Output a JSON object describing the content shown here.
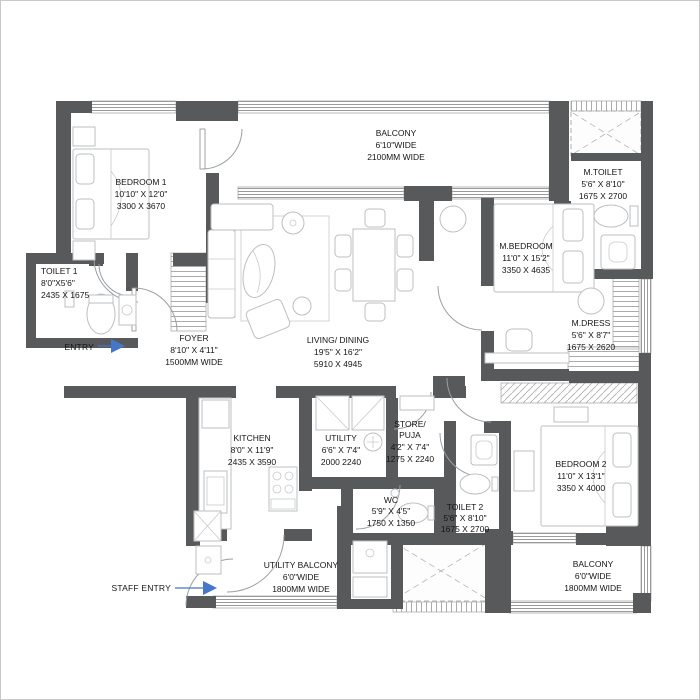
{
  "plan_title": "apartment-floor-plan",
  "rooms": {
    "balcony_top": {
      "name": "BALCONY",
      "size_ft": "6'10\"WIDE",
      "size_mm": "2100MM WIDE"
    },
    "bedroom1": {
      "name": "BEDROOM 1",
      "size_ft": "10'10\" X 12'0\"",
      "size_mm": "3300 X 3670"
    },
    "m_toilet": {
      "name": "M.TOILET",
      "size_ft": "5'6\" X 8'10\"",
      "size_mm": "1675 X 2700"
    },
    "m_bedroom": {
      "name": "M.BEDROOM",
      "size_ft": "11'0\" X 15'2\"",
      "size_mm": "3350 X 4635"
    },
    "m_dress": {
      "name": "M.DRESS",
      "size_ft": "5'6\" X 8'7\"",
      "size_mm": "1675 X 2620"
    },
    "toilet1": {
      "name": "TOILET 1",
      "size_ft": "8'0\"X5'6\"",
      "size_mm": "2435 X 1675"
    },
    "foyer": {
      "name": "FOYER",
      "size_ft": "8'10\" X 4'11\"",
      "size_mm": "1500MM WIDE"
    },
    "living_dining": {
      "name": "LIVING/ DINING",
      "size_ft": "19'5\" X 16'2\"",
      "size_mm": "5910 X 4945"
    },
    "kitchen": {
      "name": "KITCHEN",
      "size_ft": "8'0\" X 11'9\"",
      "size_mm": "2435 X 3590"
    },
    "utility": {
      "name": "UTILITY",
      "size_ft": "6'6\" X 7'4\"",
      "size_mm": "2000 2240"
    },
    "store_puja": {
      "name": "STORE/",
      "name2": "PUJA",
      "size_ft": "4'2\" X 7'4\"",
      "size_mm": "1275 X 2240"
    },
    "wc": {
      "name": "WC",
      "size_ft": "5'9\" X 4'5\"",
      "size_mm": "1750 X 1350"
    },
    "toilet2": {
      "name": "TOILET 2",
      "size_ft": "5'6\" X 8'10\"",
      "size_mm": "1675 X 2700"
    },
    "bedroom2": {
      "name": "BEDROOM 2",
      "size_ft": "11'0\" X 13'1\"",
      "size_mm": "3350 X 4000"
    },
    "utility_balcony": {
      "name": "UTILITY BALCONY",
      "size_ft": "6'0\"WIDE",
      "size_mm": "1800MM WIDE"
    },
    "balcony_bottom": {
      "name": "BALCONY",
      "size_ft": "6'0\"WIDE",
      "size_mm": "1800MM WIDE"
    }
  },
  "annotations": {
    "entry": "ENTRY",
    "staff_entry": "STAFF ENTRY"
  },
  "colors": {
    "wall": "#58595b",
    "window_line": "#8d8d8d",
    "door_arc": "#9aa0a4",
    "furniture_line": "#bcbfc1",
    "text": "#161616",
    "entry_arrow": "#4576c8"
  }
}
